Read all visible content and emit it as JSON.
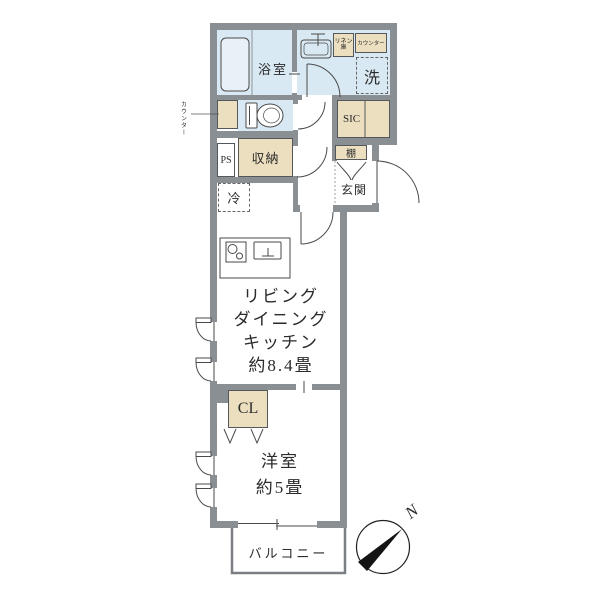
{
  "colors": {
    "wall": "#8a8f94",
    "water_room": "#d9e9f3",
    "closet_fill": "#ecdfc0",
    "line": "#4a4a4a",
    "text": "#2b2b2b"
  },
  "labels": {
    "bathroom": "浴室",
    "washer": "洗",
    "linen": "リネン庫",
    "counter_top": "カウンター",
    "counter_side": "カウンター",
    "ps": "PS",
    "storage": "収納",
    "sic": "SIC",
    "shelf": "棚",
    "entrance": "玄関",
    "fridge": "冷",
    "closet": "CL",
    "balcony": "バルコニー",
    "north": "N"
  },
  "ldk": {
    "lines": [
      "リビング",
      "ダイニング",
      "キッチン",
      "約8.4畳"
    ]
  },
  "bedroom": {
    "lines": [
      "洋室",
      "約5畳"
    ]
  }
}
